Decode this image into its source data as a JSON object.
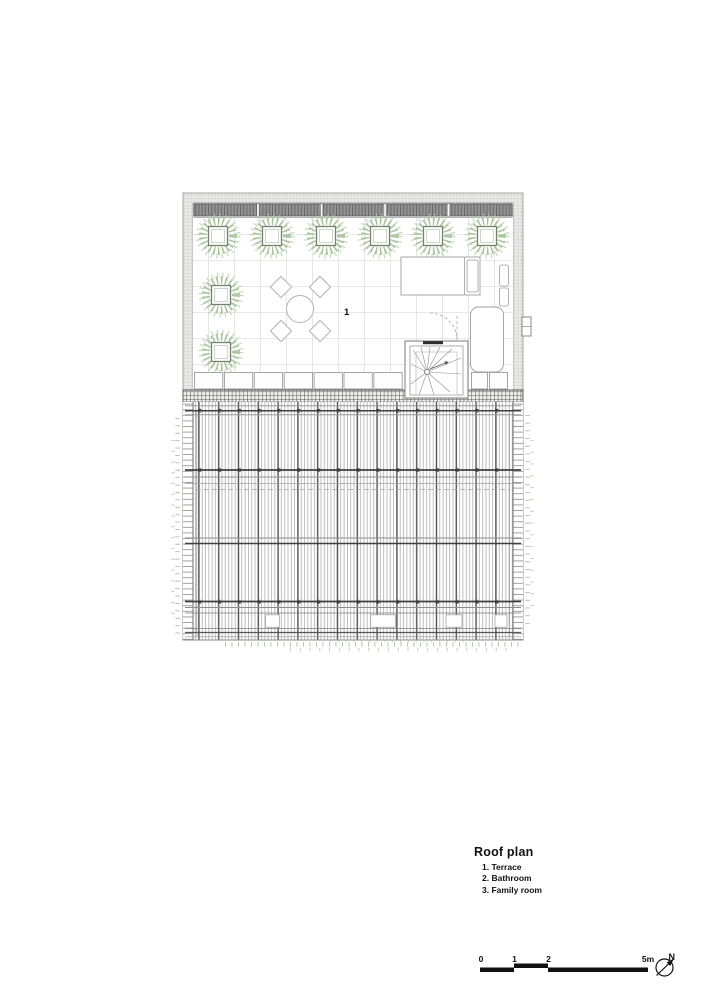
{
  "title_block": {
    "title": "Roof plan",
    "legend": [
      "1. Terrace",
      "2. Bathroom",
      "3. Family room"
    ]
  },
  "plan_labels": {
    "terrace_number": "1"
  },
  "scale_bar": {
    "tick_0": "0",
    "tick_1": "1",
    "tick_2": "2",
    "tick_end": "5m"
  },
  "compass": {
    "north_label": "N"
  },
  "colors": {
    "foliage_green": "#a8c49b",
    "ink": "#111111",
    "wall_gray": "#e7e7e6",
    "louver_gray": "#939393",
    "line_gray": "#9a9a9a"
  }
}
